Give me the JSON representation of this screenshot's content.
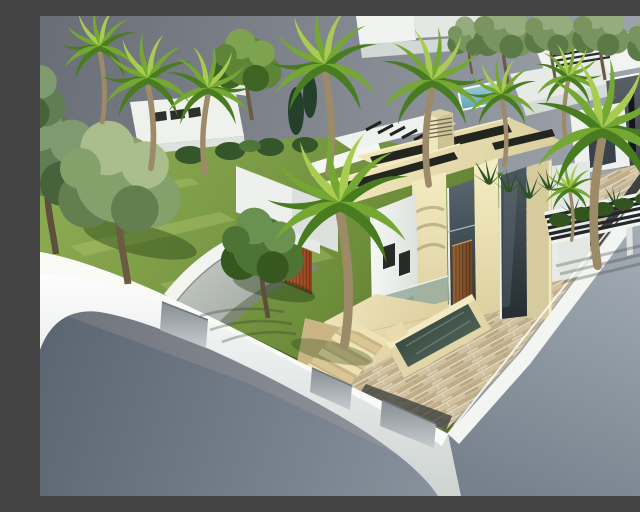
{
  "meta": {
    "type": "3d-architectural-render",
    "description": "Aerial 3D architectural rendering of a modern two-storey cream-stone villa on a corner plot with green lawn, curved concrete driveway to an orange slatted garage, striped stone paver driveway, water feature, stone steps, white perimeter walls with gray gates, slatted pergola carport, many palm and leafy trees, and neighbouring white modern houses with a dark stone-clad volume and a small pool, all set against a plain gray studio background."
  },
  "scene": {
    "main_villa": {
      "label": "modern two-storey villa",
      "features": [
        "flat beige stone roofs with linear skylight slots",
        "louvered chimney",
        "white roof wing with dark slats",
        "tall dark glass facades",
        "vertical-slat wood entry door",
        "two small dark windows",
        "cream travertine pillars"
      ]
    },
    "site": {
      "garage": "double garage with orange vertical-slat doors",
      "driveway_front": "curved gray concrete apron with white curved retaining wall",
      "driveway_side": "striped beige stone paver ramp",
      "water_feature": "raised rectangular stone trough with dark water",
      "steps": "seven beige stone steps from terrace to lawn",
      "pergola": "white carport pergola with five dark slats",
      "perimeter": "white plot walls with three recessed gray gates"
    },
    "vegetation": {
      "palm_trees": 10,
      "leafy_trees": 5,
      "conifers": 2,
      "hedges": "dark hedge row along rear boundary, spiky shrubs along right wall"
    },
    "neighbourhood": {
      "left": "white flat-roof house with roof slots and curved wall",
      "right": "white modern complex with dark stone-clad volume, slatted pergola and small blue pool"
    },
    "background": "plain gray gradient backdrop, gray foreground plinth"
  },
  "colors": {
    "skyTop": "#696d75",
    "skyRight": "#a3aab2",
    "groundDark": "#5c6673",
    "groundLight": "#a7b0b9",
    "lawn": "#7fa04a",
    "lawnDark": "#4f6d28",
    "shadowGreen": "#1f3a10",
    "wallWhite": "#f4f6f2",
    "whiteShade": "#d5dad6",
    "gateGray": "#9aa1a6",
    "apronGray": "#b9bfb9",
    "stoneSun": "#efe6bb",
    "stoneShade": "#d6cb9d",
    "roofBeige": "#e9dfb2",
    "slotBlack": "#23261e",
    "glassDark": "#3f4a51",
    "woodDoor": "#8a5a33",
    "garageDoor": "#b05a2e",
    "paverBase": "#cfc1a2",
    "paverDark": "#b6a37e",
    "terraceStone": "#e7dab0",
    "waterDark": "#36453d",
    "poolBlue": "#6fb0c4",
    "cladDark": "#54585e",
    "palmLight": "#a8cc52",
    "palmMid": "#74a832",
    "palmDark": "#497c20",
    "palmTrunk": "#9c8a69",
    "treeTrunk": "#6b5b43",
    "treeMuted": "#7d9768",
    "treeMutedLight": "#9fb487",
    "treeMutedDark": "#5d7b4b",
    "shrubDark": "#2d5226"
  }
}
